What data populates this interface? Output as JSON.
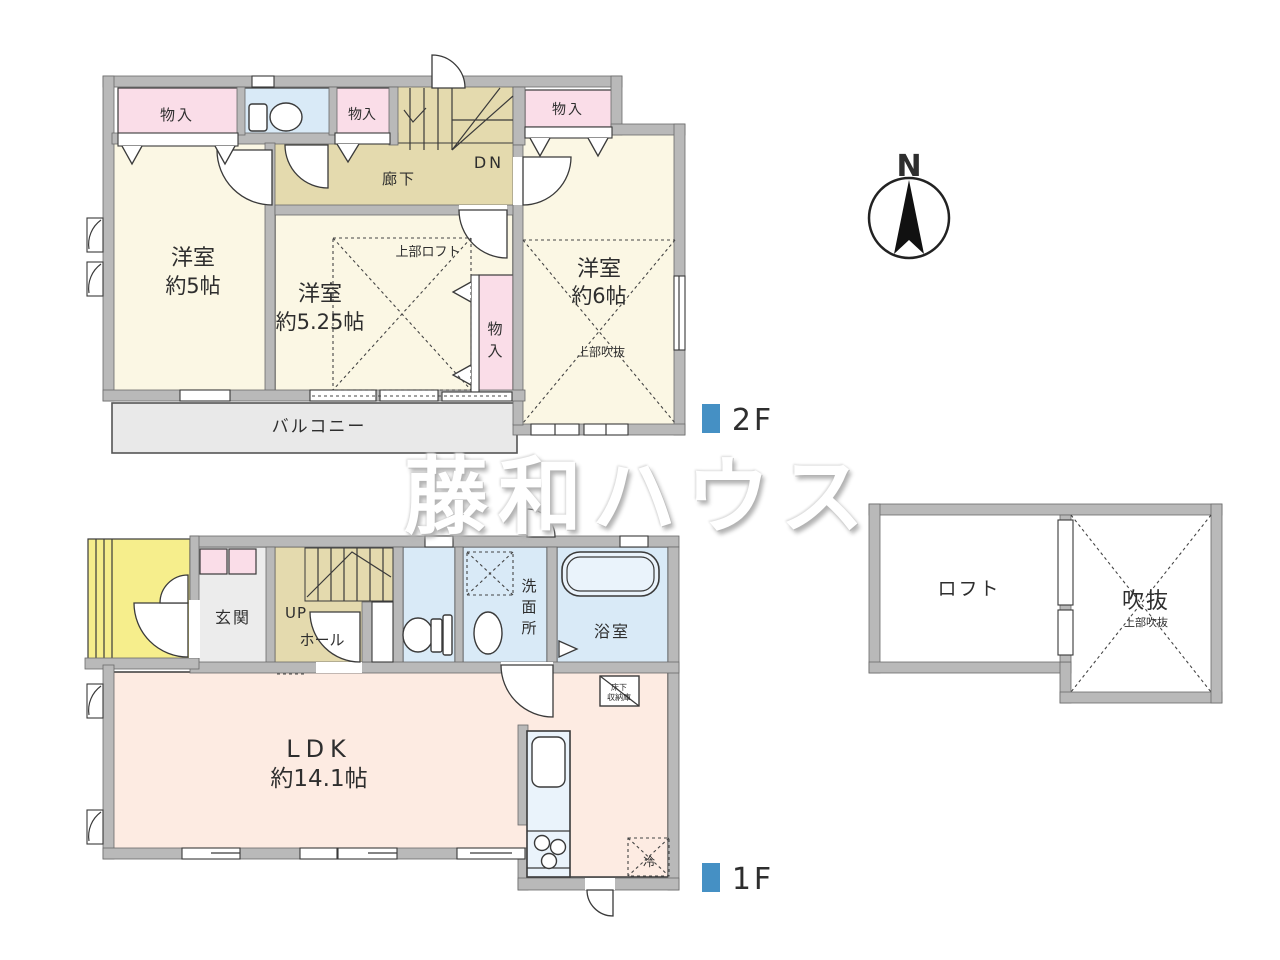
{
  "watermark": "藤和ハウス",
  "compass": {
    "north_label": "N"
  },
  "colors": {
    "accent": "#4590c4",
    "wall": "#b9b9b9",
    "wall-edge": "#6a6a6a",
    "cream": "#fbf7e4",
    "pink": "#fadde8",
    "blue": "#d9eaf7",
    "tan": "#e4daae",
    "peach": "#fdebe2",
    "balcony": "#e9e9e9",
    "yellow": "#f6ee8c",
    "line": "#333333",
    "text": "#2e2e2e"
  },
  "floor2": {
    "marker": "2F",
    "closet_top_left": "物入",
    "closet_top_mid": "物入",
    "closet_top_right": "物入",
    "closet_vertical_chars": [
      "物",
      "入"
    ],
    "corridor": "廊下",
    "stairs_down": "DN",
    "room_west": {
      "name": "洋室",
      "size": "約5帖"
    },
    "room_center": {
      "name": "洋室",
      "size": "約5.25帖"
    },
    "room_east": {
      "name": "洋室",
      "size": "約6帖"
    },
    "loft_above_note": "上部ロフト",
    "void_above_note": "上部吹抜",
    "balcony": "バルコニー"
  },
  "floor1": {
    "marker": "1F",
    "entrance": "玄関",
    "stairs_up": "UP",
    "hall": "ホール",
    "washroom_chars": [
      "洗",
      "面",
      "所"
    ],
    "bathroom": "浴室",
    "ldk": {
      "name": "LDK",
      "size": "約14.1帖"
    },
    "underfloor_storage_lines": [
      "床下",
      "収納庫"
    ],
    "fridge": "冷"
  },
  "loft_plan": {
    "loft": "ロフト",
    "void": "吹抜",
    "void_above_note": "上部吹抜"
  }
}
